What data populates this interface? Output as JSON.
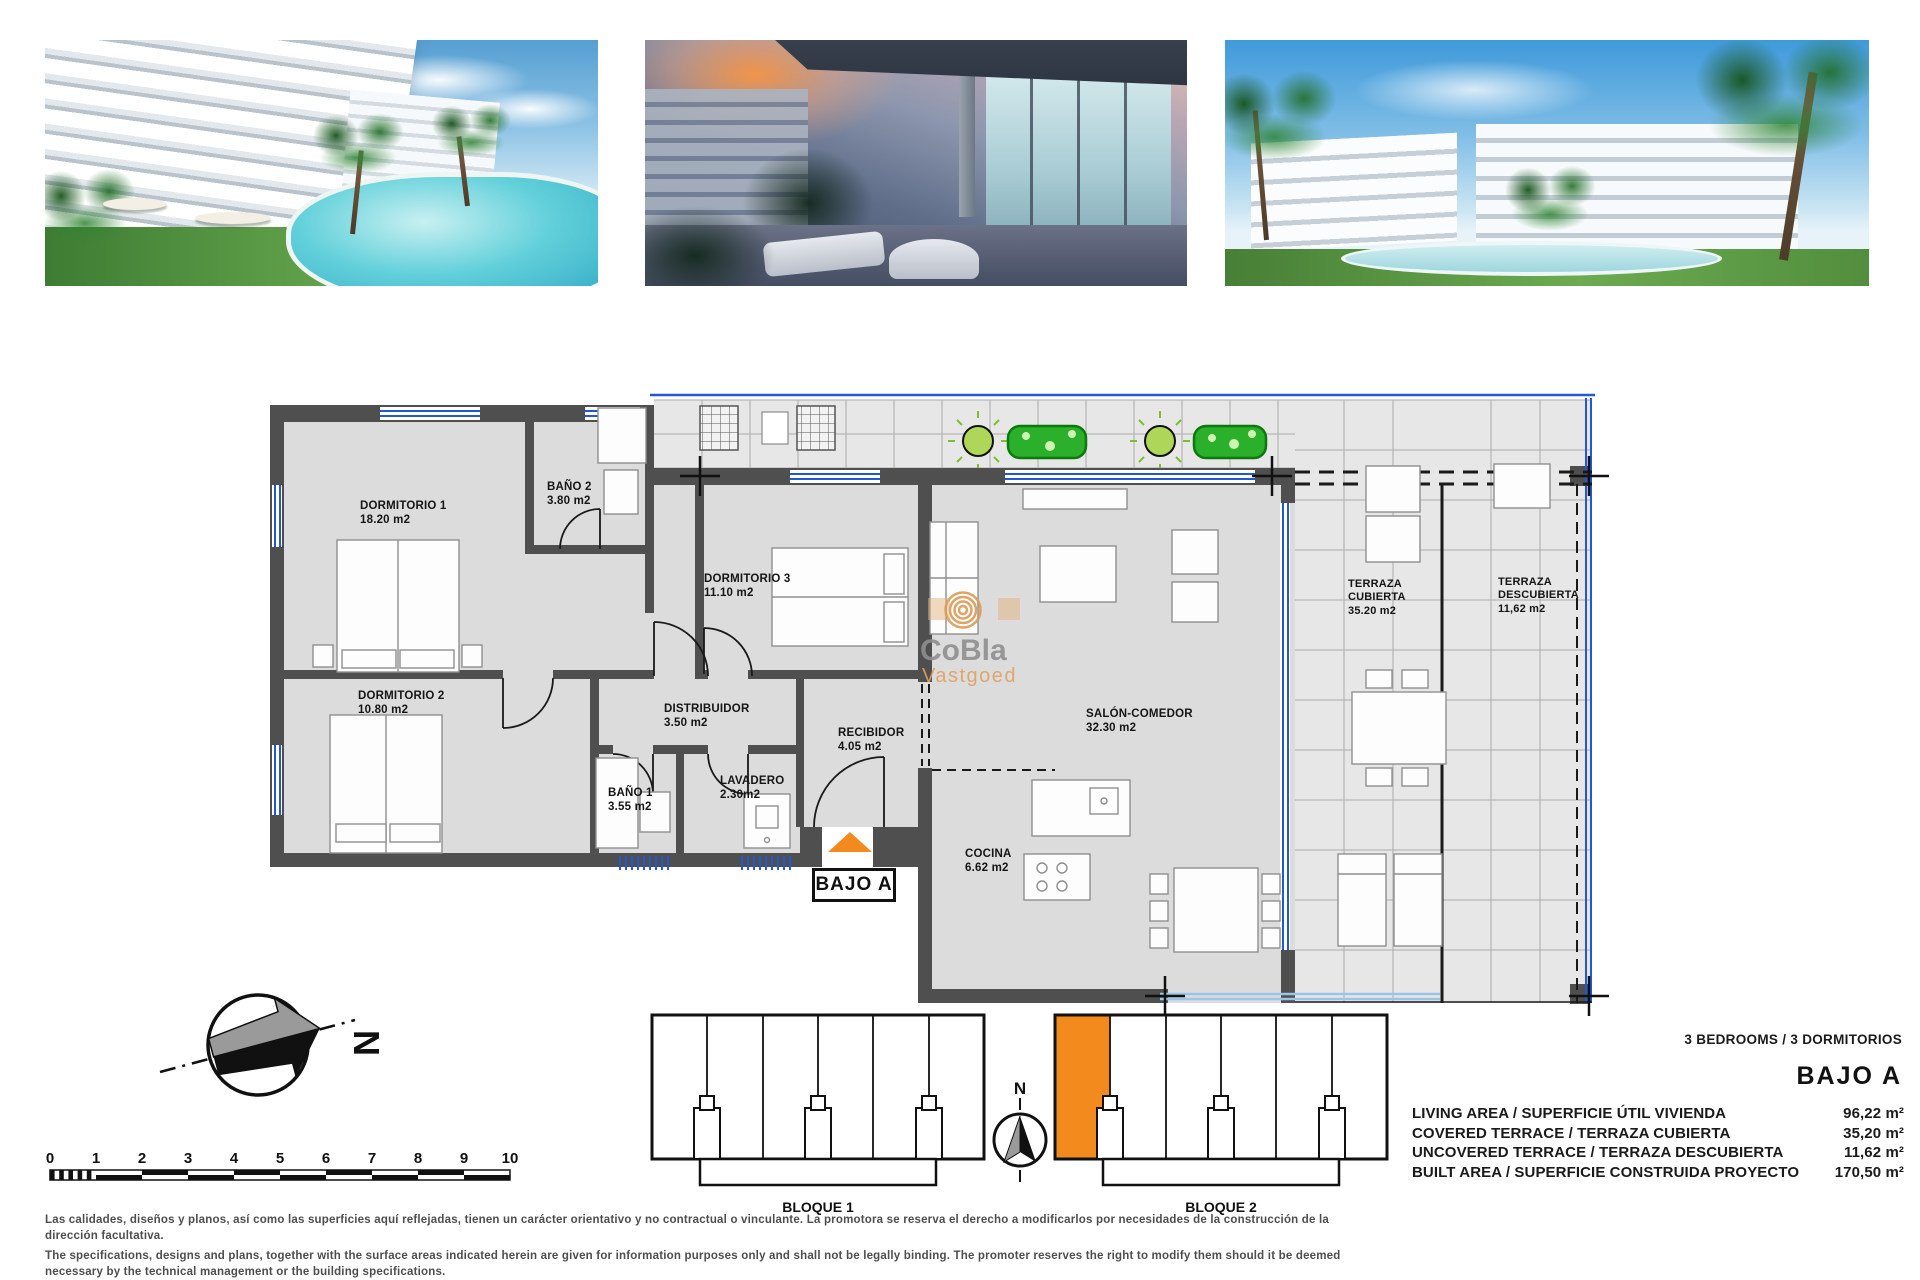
{
  "floorplan": {
    "unit_label": "BAJO A",
    "watermark": {
      "brand": "CoBla",
      "sub": "Vastgoed"
    },
    "rooms": [
      {
        "label": "DORMITORIO 1",
        "area": "18.20 m2"
      },
      {
        "label": "BAÑO 2",
        "area": "3.80 m2"
      },
      {
        "label": "DORMITORIO 3",
        "area": "11.10 m2"
      },
      {
        "label": "DORMITORIO 2",
        "area": "10.80 m2"
      },
      {
        "label": "DISTRIBUIDOR",
        "area": "3.50 m2"
      },
      {
        "label": "BAÑO 1",
        "area": "3.55 m2"
      },
      {
        "label": "LAVADERO",
        "area": "2.30m2"
      },
      {
        "label": "RECIBIDOR",
        "area": "4.05 m2"
      },
      {
        "label": "SALÓN-COMEDOR",
        "area": "32.30 m2"
      },
      {
        "label": "COCINA",
        "area": "6.62 m2"
      },
      {
        "label": "TERRAZA CUBIERTA",
        "area": "35.20 m2"
      },
      {
        "label": "TERRAZA DESCUBIERTA",
        "area": "11,62 m2"
      }
    ]
  },
  "site_plan": {
    "bloque1_label": "BLOQUE 1",
    "bloque2_label": "BLOQUE 2",
    "north_label": "N",
    "small_north_label": "N",
    "scale_ticks": [
      "0",
      "1",
      "2",
      "3",
      "4",
      "5",
      "6",
      "7",
      "8",
      "9",
      "10"
    ]
  },
  "summary": {
    "bedrooms": "3 BEDROOMS / 3 DORMITORIOS",
    "unit": "BAJO A",
    "rows": [
      {
        "label": "LIVING AREA / SUPERFICIE ÚTIL VIVIENDA",
        "value": "96,22 m²"
      },
      {
        "label": "COVERED TERRACE / TERRAZA CUBIERTA",
        "value": "35,20 m²"
      },
      {
        "label": "UNCOVERED TERRACE / TERRAZA DESCUBIERTA",
        "value": "11,62 m²"
      },
      {
        "label": "BUILT AREA / SUPERFICIE CONSTRUIDA PROYECTO",
        "value": "170,50 m²"
      }
    ]
  },
  "disclaimer": {
    "es": "Las calidades, diseños y planos, así como las superficies aquí reflejadas, tienen un carácter orientativo y no contractual o vinculante. La promotora se reserva el derecho a modificarlos por necesidades de la construcción de la dirección facultativa.",
    "en": "The specifications, designs and plans, together with the surface areas indicated herein are given for information purposes only and shall not be legally binding. The promoter reserves the right to modify them should it be deemed necessary by the technical management or the building specifications."
  },
  "colors": {
    "accent_orange": "#F28A1E",
    "wall_gray": "#4F4F4F",
    "room_fill": "#DCDCDC",
    "terrace_fill": "#E7E7E7",
    "window_blue": "#2257D6",
    "plant_green": "#2BB02B",
    "watermark_orange": "#DFA261",
    "watermark_gray": "#8F8F8F"
  }
}
